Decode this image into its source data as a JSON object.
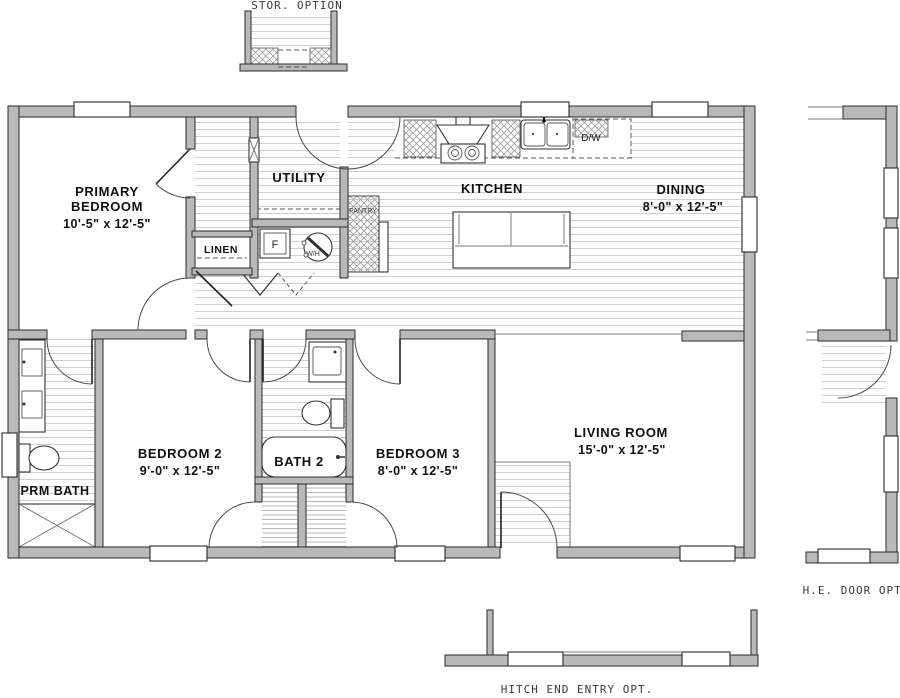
{
  "plan_title": "single-section-home-floor-plan",
  "colors": {
    "wall": "#b9b9b9",
    "outline": "#2b2b2b",
    "hatch": "#d0d0d0",
    "label": "#111111",
    "option_label": "#3a3a3a"
  },
  "options": {
    "storage": {
      "label": "STOR. OPTION"
    },
    "he_door": {
      "label": "H.E. DOOR OPT."
    },
    "hitch": {
      "label": "HITCH END ENTRY OPT."
    }
  },
  "rooms": {
    "primary_bedroom": {
      "name_line1": "PRIMARY",
      "name_line2": "BEDROOM",
      "dims": "10'-5\" x  12'-5\""
    },
    "utility": {
      "name": "UTILITY"
    },
    "linen": {
      "name": "LINEN"
    },
    "kitchen": {
      "name": "KITCHEN"
    },
    "dining": {
      "name": "DINING",
      "dims": "8'-0\" x  12'-5\""
    },
    "prm_bath": {
      "name": "PRM BATH"
    },
    "bedroom2": {
      "name": "BEDROOM 2",
      "dims": "9'-0\" x  12'-5\""
    },
    "bath2": {
      "name": "BATH 2"
    },
    "bedroom3": {
      "name": "BEDROOM 3",
      "dims": "8'-0\" x  12'-5\""
    },
    "living_room": {
      "name": "LIVING ROOM",
      "dims": "15'-0\" x  12'-5\""
    }
  },
  "fixtures": {
    "dishwasher": "D/W",
    "furnace": "F",
    "water_heater": "W/H",
    "pantry": "PANTRY"
  }
}
